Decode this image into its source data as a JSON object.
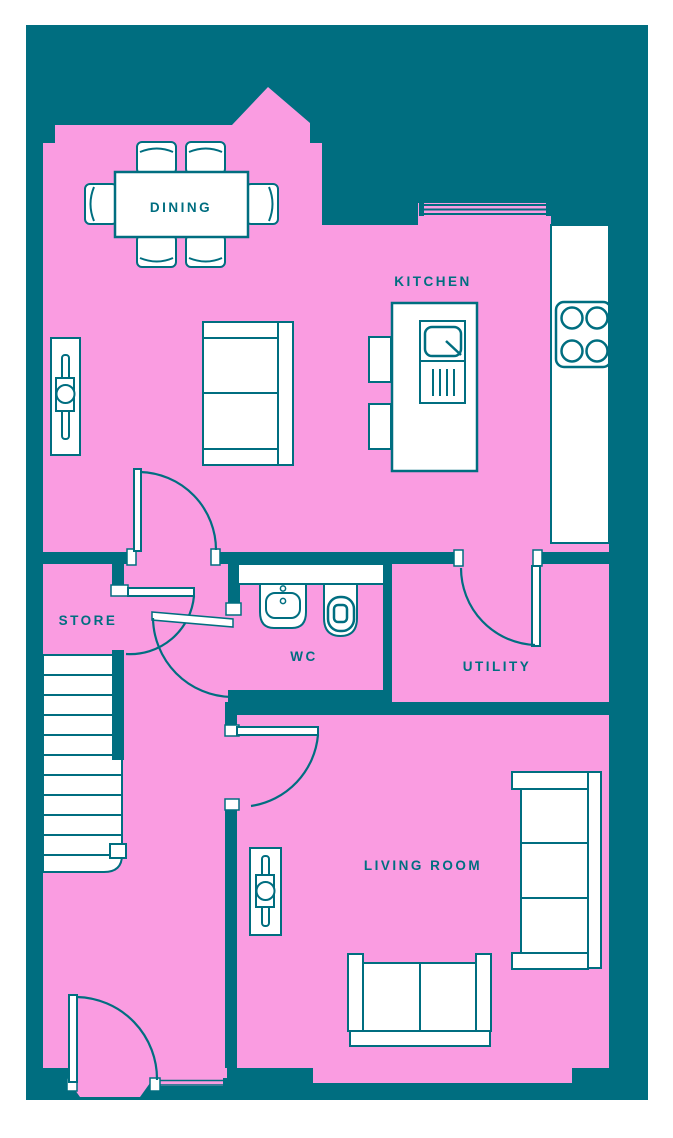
{
  "floorplan": {
    "title": "ground-floor-plan",
    "colors": {
      "wall_background": "#006E80",
      "floor": "#FA9CE1",
      "furniture": "#FFFFFF",
      "line_and_text": "#006E80",
      "page_margin": "#FFFFFF"
    },
    "rooms": [
      {
        "id": "dining",
        "label": "DINING"
      },
      {
        "id": "kitchen",
        "label": "KITCHEN"
      },
      {
        "id": "store",
        "label": "STORE"
      },
      {
        "id": "wc",
        "label": "WC"
      },
      {
        "id": "utility",
        "label": "UTILITY"
      },
      {
        "id": "living_room",
        "label": "LIVING ROOM"
      }
    ],
    "furniture": [
      "dining-table",
      "dining-chairs-x6",
      "sofa-two-seat",
      "radiator-x2",
      "kitchen-island-with-sink",
      "bar-stools-x2",
      "counter",
      "hob-four-burner",
      "wc-basin",
      "wc-toilet",
      "staircase",
      "sofa-three-seat",
      "sofa-two-seat-bottom"
    ],
    "openings": [
      "window-kitchen-top",
      "door-dining-hall",
      "door-store",
      "door-wc",
      "door-utility",
      "door-living-room",
      "door-front-entrance",
      "sidelight-front"
    ]
  }
}
